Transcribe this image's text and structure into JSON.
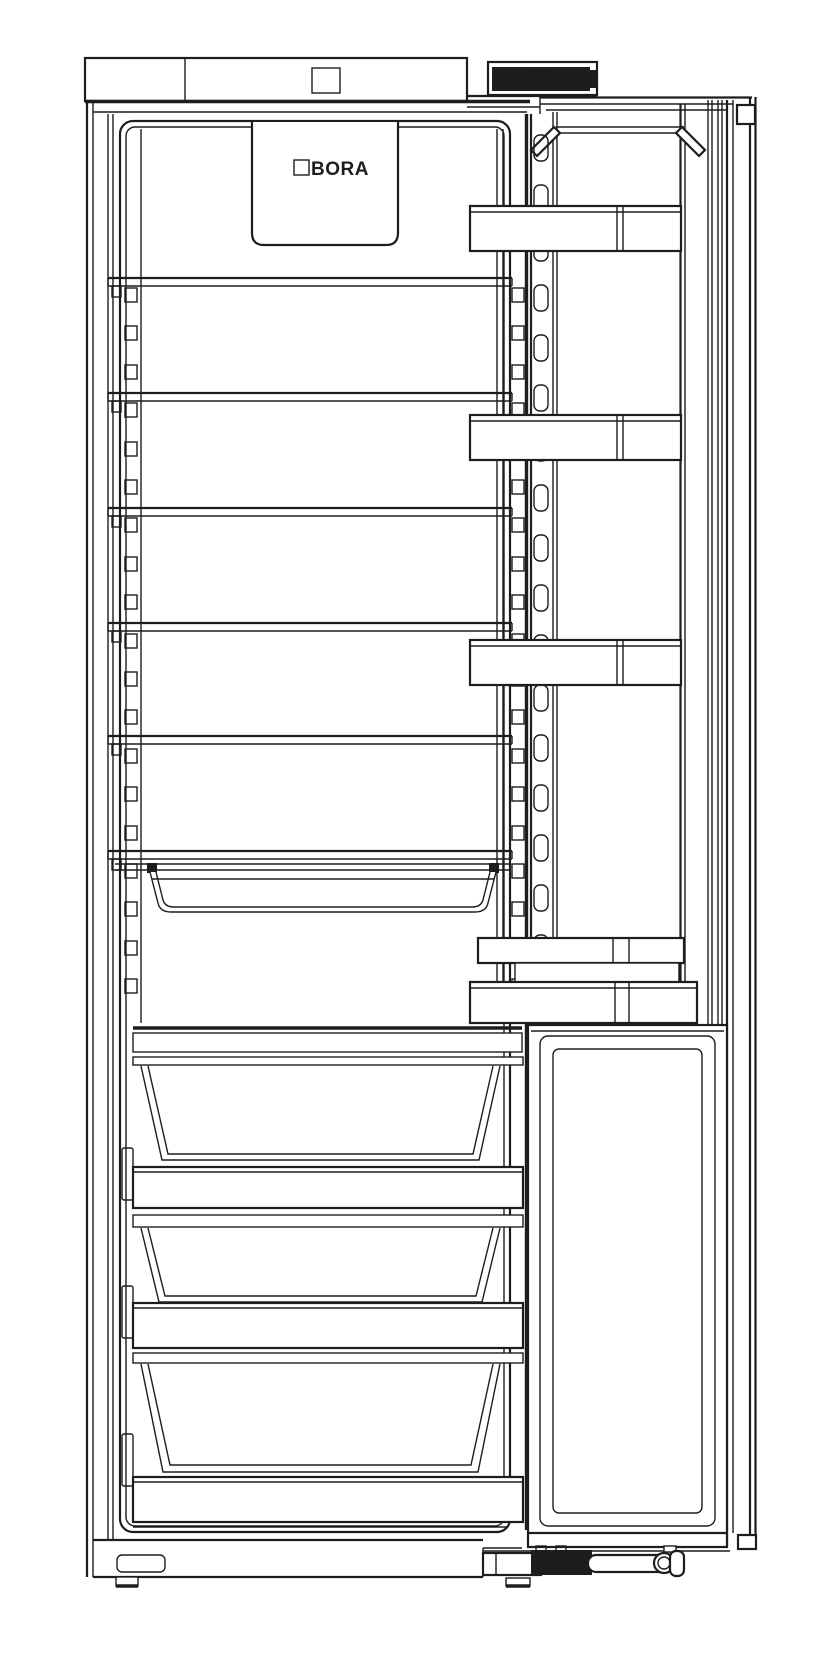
{
  "figure": {
    "brand": "BORA",
    "colors": {
      "line": "#1d1d1b",
      "background": "#ffffff"
    },
    "depicted": {
      "shelves": 6,
      "door_bins": 5,
      "pull_out_tray": 1,
      "vegetable_drawers": 3
    }
  }
}
